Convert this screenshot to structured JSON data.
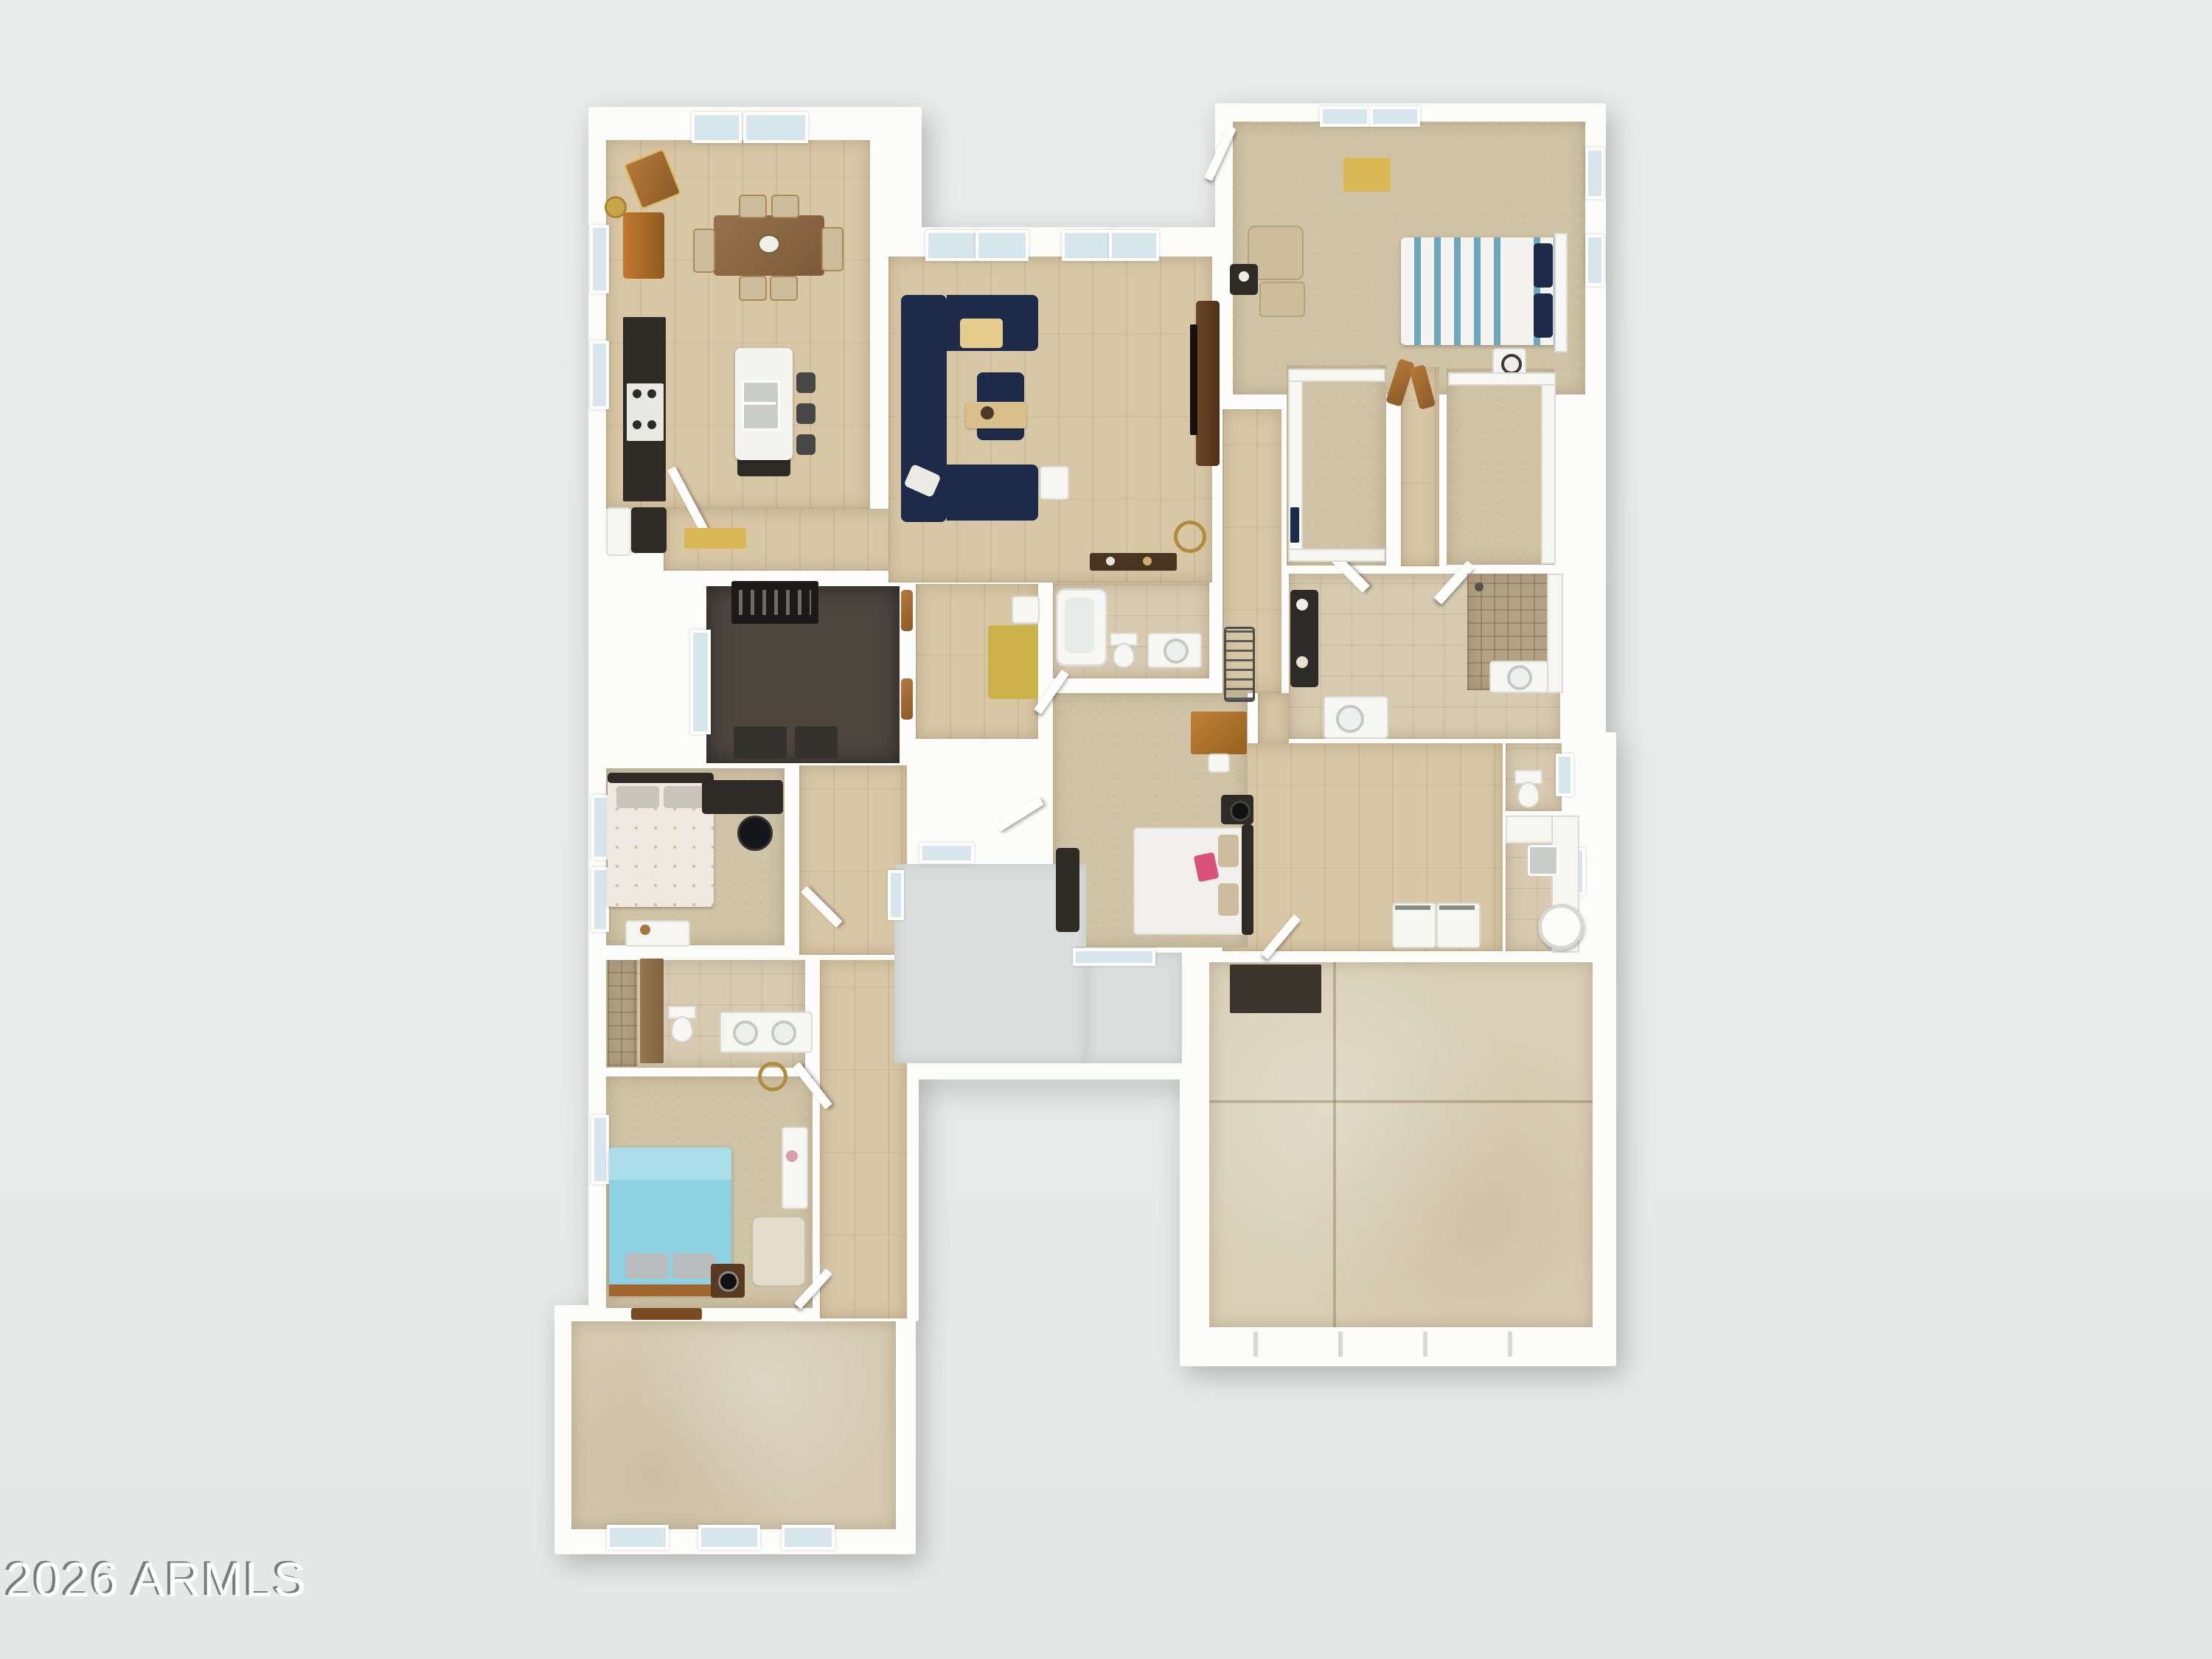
{
  "watermark": {
    "text": "2026 ARMLS"
  },
  "palette": {
    "background": "#e9ebeb",
    "wall": "#fcfcfb",
    "wood_floor": "#d8c7a5",
    "carpet": "#cfc3a5",
    "bath_tile": "#d7cab0",
    "gym_floor": "#4d463f",
    "garage_concrete": "#d9cfb6",
    "patio_concrete": "#d5cab1",
    "porch_concrete": "#dcdede",
    "shower_tile": "#b3a184",
    "sofa_navy": "#1e2a4a",
    "accent_gold": "#d9b855",
    "bed_teal": "#8ed1e2",
    "bed_stripe_blue": "#6ca7bd",
    "dining_wood": "#8a6544",
    "cabinet_dark": "#2e2a26",
    "window_glass": "#d7e6ec",
    "pink_pillow": "#d8527c"
  }
}
